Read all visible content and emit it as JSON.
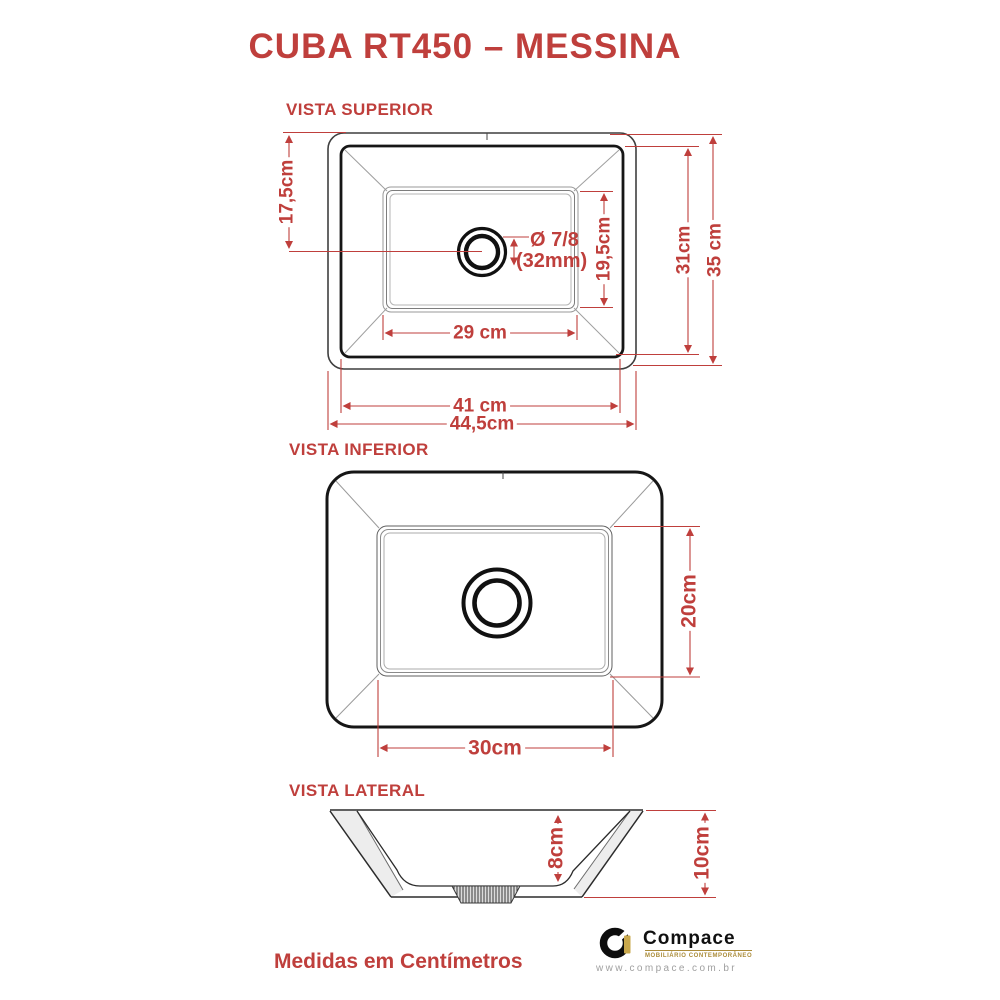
{
  "title": "CUBA RT450 – MESSINA",
  "footer_note": "Medidas em Centímetros",
  "views": {
    "superior": {
      "label": "VISTA SUPERIOR",
      "dims": {
        "edge_to_drain": "17,5cm",
        "drain_dia_inch": "Ø 7/8",
        "drain_dia_mm": "(32mm)",
        "basin_length": "19,5cm",
        "rim_height": "31cm",
        "total_height": "35 cm",
        "basin_width": "29 cm",
        "rim_width": "41 cm",
        "total_width": "44,5cm"
      }
    },
    "inferior": {
      "label": "VISTA INFERIOR",
      "dims": {
        "base_depth": "20cm",
        "base_width": "30cm"
      }
    },
    "lateral": {
      "label": "VISTA LATERAL",
      "dims": {
        "bowl_depth": "8cm",
        "height": "10cm"
      }
    }
  },
  "brand": {
    "name": "Compace",
    "tagline": "MOBILIÁRIO CONTEMPORÂNEO",
    "website": "www.compace.com.br"
  },
  "colors": {
    "dimension_red": "#bf3f3c",
    "line_dark": "#1c1c1c",
    "gold": "#ab8c3a"
  }
}
